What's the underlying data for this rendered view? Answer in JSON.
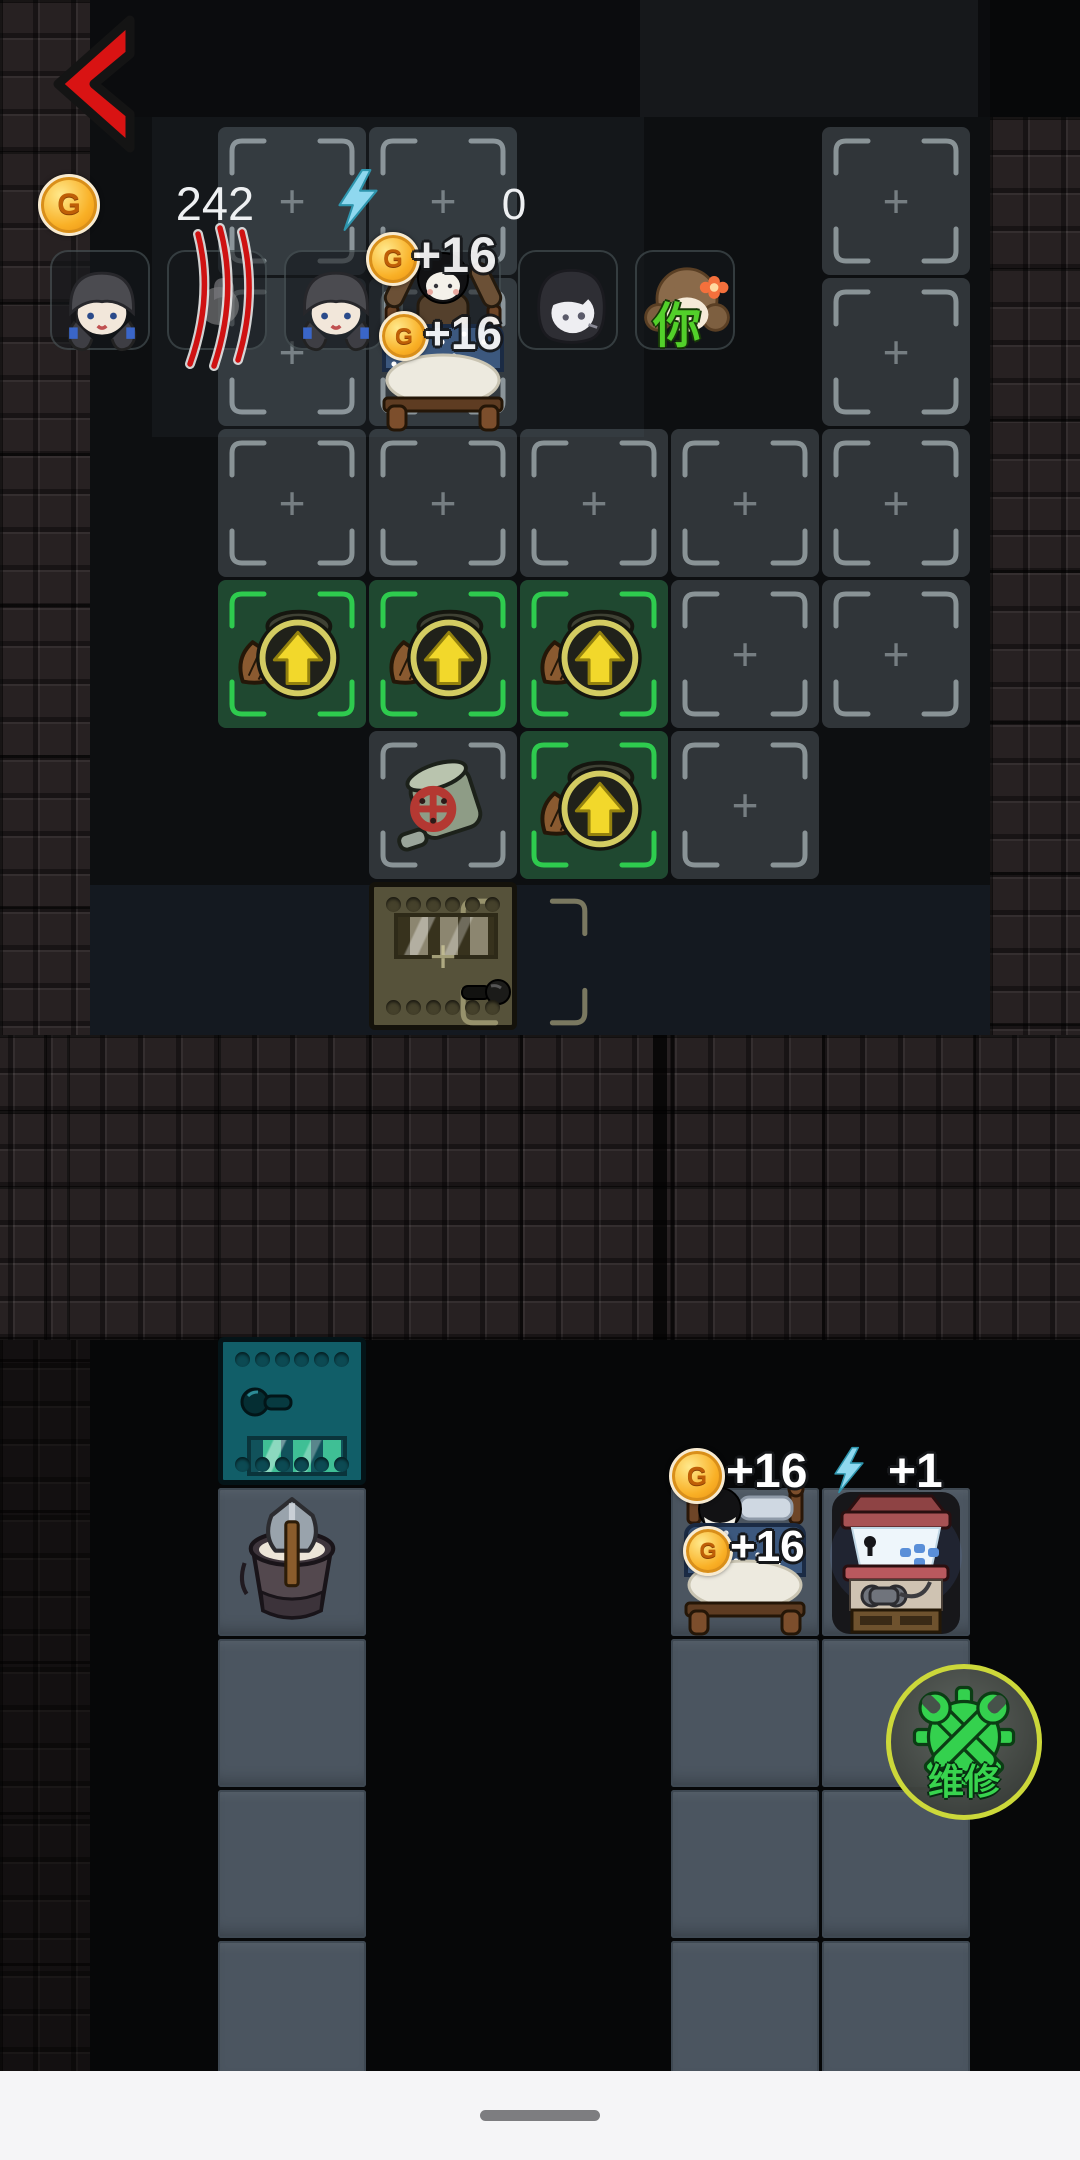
{
  "hud": {
    "back_icon": "chevron-left",
    "coin_icon": "coin-G",
    "coins_value": "242",
    "energy_icon": "lightning-bolt",
    "energy_value": "0"
  },
  "symbols": {
    "plus": "+",
    "coin_letter": "G"
  },
  "party": {
    "members": [
      {
        "id": "girl-pigtails",
        "status": "normal"
      },
      {
        "id": "injured-member",
        "status": "claw-marks"
      },
      {
        "id": "girl-pigtails-2",
        "status": "normal"
      },
      {
        "id": "boy-in-bed",
        "status": "behind-bed"
      },
      {
        "id": "pale-girl",
        "status": "normal"
      },
      {
        "id": "player-character",
        "status": "normal",
        "overlay": "你"
      }
    ]
  },
  "rewards": {
    "upper_bed": [
      {
        "type": "coin",
        "text": "+16"
      },
      {
        "type": "coin",
        "text": "+16"
      }
    ],
    "lower_room": {
      "coin_total": "+16",
      "energy_total": "+1",
      "bed_coin": "+16"
    }
  },
  "board": {
    "upper_grid": {
      "empty_plus_tiles": 13,
      "upgrade_item_tiles": 4,
      "valve_item_tiles": 1,
      "door_tile": "olive-metal-door",
      "bed_tile": "occupied-bed"
    },
    "lower_left_room": {
      "door_tile": "teal-metal-door",
      "bucket_tile": "bucket-with-shovel",
      "floor_tiles": 3
    },
    "lower_right_room": {
      "bed_tile": "sleeping-bed",
      "arcade_tile": "arcade-machine",
      "floor_tiles": 6
    }
  },
  "repair_button": {
    "label": "维修",
    "icon": "wrench-gear"
  },
  "colors": {
    "back_arrow": "#d91313",
    "coin_gold": "#f9b026",
    "energy_blue": "#8fd8ef",
    "tile_highlight_green": "#2ecb4e",
    "door_olive": "#56523a",
    "door_teal": "#115e68",
    "repair_green": "#38d44e",
    "repair_ring": "#ccd83a",
    "reward_text": "#ffffff"
  }
}
